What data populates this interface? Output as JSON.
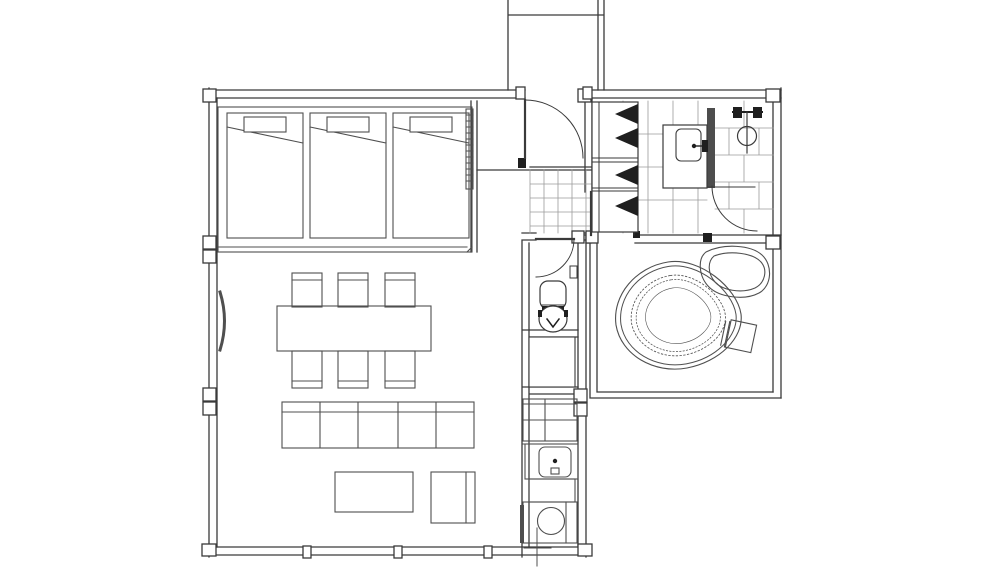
{
  "meta": {
    "title": "Architectural floor plan drawing",
    "drawing_type": "top-down plan, black line work on white",
    "has_text": false
  },
  "palette": {
    "background": "#ffffff",
    "wall_line": "#3a3a3a",
    "furniture_line": "#4f4f4f",
    "tile_line": "#9b9b9b",
    "fixture_fill": "#1f1f1f",
    "partition_fill": "#4d4d4d"
  },
  "rooms": [
    {
      "id": "approach-corridor",
      "label": "approach corridor at top leading to entry door"
    },
    {
      "id": "entry-hall",
      "label": "entry hall with tiled doma floor and swing door"
    },
    {
      "id": "bedroom",
      "label": "bedroom platform with three beds"
    },
    {
      "id": "living-dining",
      "label": "living and dining room"
    },
    {
      "id": "kitchen",
      "label": "kitchen strip with counters, sink and round cooktop"
    },
    {
      "id": "toilet-room",
      "label": "toilet room with swing door"
    },
    {
      "id": "storage-closet",
      "label": "storage closet below toilet room"
    },
    {
      "id": "washroom",
      "label": "washroom with vanity sink and shelf cabinet, tiled floor"
    },
    {
      "id": "shower-room",
      "label": "shower room with running-bond tile and mixer fixture"
    },
    {
      "id": "bath-room",
      "label": "bath room with free-form contoured bathtub, rock and stool"
    }
  ],
  "furniture_counts": {
    "beds": 3,
    "bed_pillows": 3,
    "dining_chairs": 6,
    "dining_tables": 1,
    "sofa_seats": 5,
    "coffee_tables": 1,
    "armchairs": 1,
    "door_swings": 4
  },
  "fixtures": [
    "entry-door",
    "toilet",
    "toilet-paper-holder",
    "vanity-sink",
    "faucet",
    "shower-mixer",
    "shoe-cabinet",
    "kitchen-sink",
    "cooktop-burner",
    "bathtub",
    "bath-stool",
    "garden-rock",
    "supply-marker-cross"
  ]
}
